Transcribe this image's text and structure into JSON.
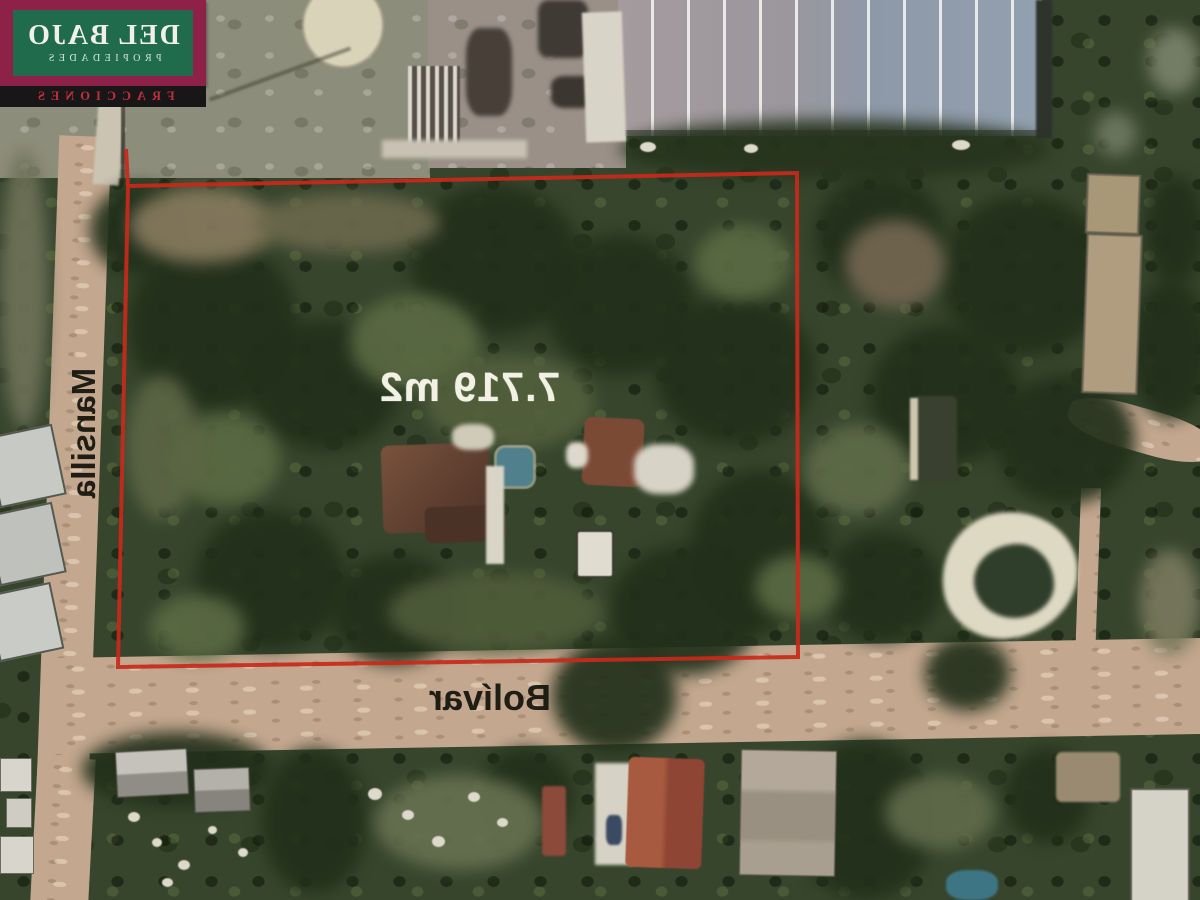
{
  "brand": {
    "line1": "DEL BAJO",
    "line2": "PROPIEDADES",
    "banner": "FRACCIONES",
    "colors": {
      "plate": "#8e2147",
      "plate_inner": "#1f6b4b",
      "banner_bg": "#191617",
      "banner_text": "#c22f3e"
    }
  },
  "parcel": {
    "area_label": "7.719 m2",
    "outline_color": "#c8291a"
  },
  "streets": [
    {
      "name": "Mansilla",
      "orientation": "vertical"
    },
    {
      "name": "Bolívar",
      "orientation": "horizontal"
    }
  ]
}
